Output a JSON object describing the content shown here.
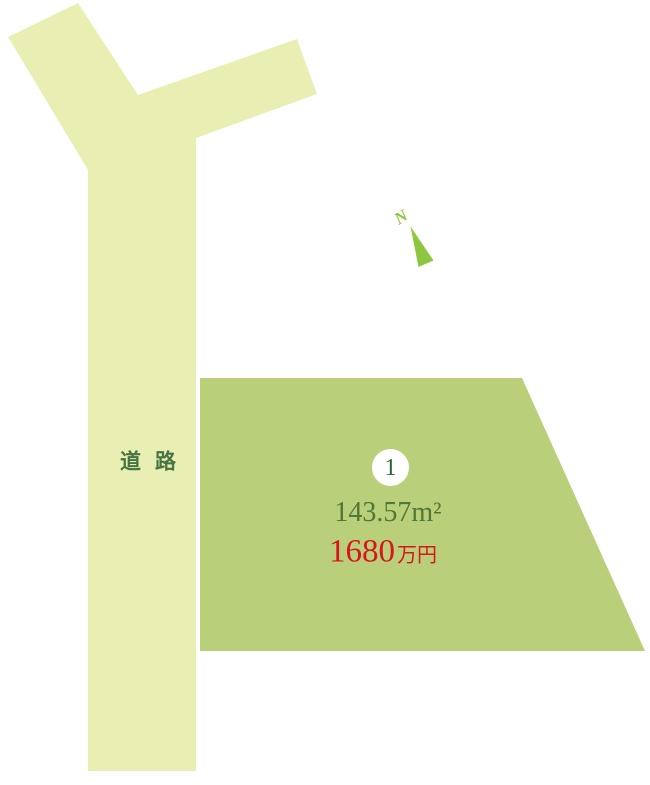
{
  "diagram": {
    "background_color": "#ffffff",
    "road": {
      "label": "道路",
      "fill": "#E9EFB3",
      "label_color": "#477442"
    },
    "plot": {
      "fill": "#BACF79",
      "number": "1",
      "number_color": "#2F6633",
      "badge_fill": "#ffffff",
      "area": "143.57m²",
      "area_color": "#4D7836",
      "price_value": "1680",
      "price_unit": "万円",
      "price_color": "#D8141E"
    },
    "compass": {
      "label": "N",
      "color": "#8EC63F"
    }
  }
}
